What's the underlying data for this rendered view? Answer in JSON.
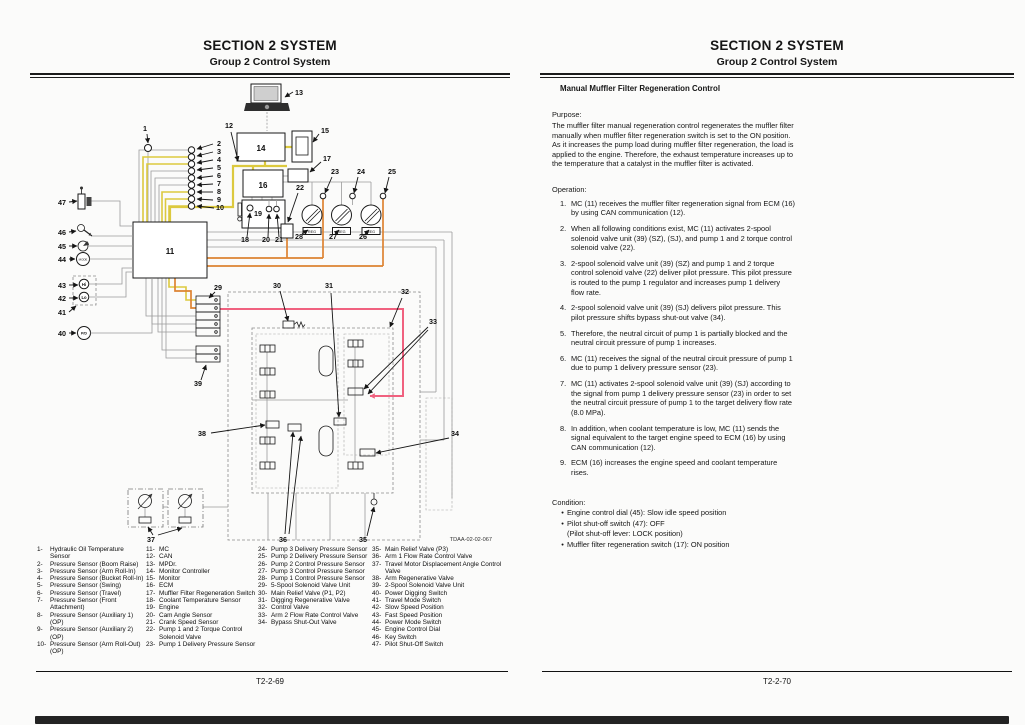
{
  "left_page": {
    "header": {
      "line1": "SECTION 2 SYSTEM",
      "line2": "Group 2 Control System"
    },
    "footer": {
      "page_number": "T2-2-69"
    },
    "diagram": {
      "figure_code": "TDAA-02-02-067",
      "component_text": {
        "reg": "REG",
        "hi": "Hi",
        "lo": "Lo",
        "power_dig": "P/D",
        "mode": "MODE"
      },
      "callouts": [
        "1",
        "2",
        "3",
        "4",
        "5",
        "6",
        "7",
        "8",
        "9",
        "10",
        "11",
        "12",
        "13",
        "14",
        "15",
        "16",
        "17",
        "18",
        "19",
        "20",
        "21",
        "22",
        "23",
        "24",
        "25",
        "26",
        "27",
        "28",
        "29",
        "30",
        "31",
        "32",
        "33",
        "34",
        "35",
        "36",
        "37",
        "38",
        "39",
        "40",
        "41",
        "42",
        "43",
        "44",
        "45",
        "46",
        "47"
      ]
    },
    "legend": {
      "col1": [
        {
          "n": "1-",
          "t": "Hydraulic Oil Temperature Sensor"
        },
        {
          "n": "2-",
          "t": "Pressure Sensor (Boom Raise)"
        },
        {
          "n": "3-",
          "t": "Pressure Sensor (Arm Roll-In)"
        },
        {
          "n": "4-",
          "t": "Pressure Sensor (Bucket Roll-In)"
        },
        {
          "n": "5-",
          "t": "Pressure Sensor (Swing)"
        },
        {
          "n": "6-",
          "t": "Pressure Sensor (Travel)"
        },
        {
          "n": "7-",
          "t": "Pressure Sensor (Front Attachment)"
        },
        {
          "n": "8-",
          "t": "Pressure Sensor (Auxiliary 1) (OP)"
        },
        {
          "n": "9-",
          "t": "Pressure Sensor (Auxiliary 2) (OP)"
        },
        {
          "n": "10-",
          "t": "Pressure Sensor (Arm Roll-Out) (OP)"
        }
      ],
      "col2": [
        {
          "n": "11-",
          "t": "MC"
        },
        {
          "n": "12-",
          "t": "CAN"
        },
        {
          "n": "13-",
          "t": "MPDr."
        },
        {
          "n": "14-",
          "t": "Monitor Controller"
        },
        {
          "n": "15-",
          "t": "Monitor"
        },
        {
          "n": "16-",
          "t": "ECM"
        },
        {
          "n": "17-",
          "t": "Muffler Filter Regeneration Switch"
        },
        {
          "n": "18-",
          "t": "Coolant Temperature Sensor"
        },
        {
          "n": "19-",
          "t": "Engine"
        },
        {
          "n": "20-",
          "t": "Cam Angle Sensor"
        },
        {
          "n": "21-",
          "t": "Crank Speed Sensor"
        },
        {
          "n": "22-",
          "t": "Pump 1 and 2 Torque Control Solenoid Valve"
        },
        {
          "n": "23-",
          "t": "Pump 1 Delivery Pressure Sensor"
        }
      ],
      "col3": [
        {
          "n": "24-",
          "t": "Pump 3 Delivery Pressure Sensor"
        },
        {
          "n": "25-",
          "t": "Pump 2 Delivery Pressure Sensor"
        },
        {
          "n": "26-",
          "t": "Pump 2 Control Pressure Sensor"
        },
        {
          "n": "27-",
          "t": "Pump 3 Control Pressure Sensor"
        },
        {
          "n": "28-",
          "t": "Pump 1 Control Pressure Sensor"
        },
        {
          "n": "29-",
          "t": "5-Spool Solenoid Valve Unit"
        },
        {
          "n": "30-",
          "t": "Main Relief Valve (P1, P2)"
        },
        {
          "n": "31-",
          "t": "Digging Regenerative Valve"
        },
        {
          "n": "32-",
          "t": "Control Valve"
        },
        {
          "n": "33-",
          "t": "Arm 2 Flow Rate Control Valve"
        },
        {
          "n": "34-",
          "t": "Bypass Shut-Out Valve"
        }
      ],
      "col4": [
        {
          "n": "35-",
          "t": "Main Relief Valve (P3)"
        },
        {
          "n": "36-",
          "t": "Arm 1 Flow Rate Control Valve"
        },
        {
          "n": "37-",
          "t": "Travel Motor Displacement Angle Control Valve"
        },
        {
          "n": "38-",
          "t": "Arm Regenerative Valve"
        },
        {
          "n": "39-",
          "t": "2-Spool Solenoid Valve Unit"
        },
        {
          "n": "40-",
          "t": "Power Digging Switch"
        },
        {
          "n": "41-",
          "t": "Travel Mode Switch"
        },
        {
          "n": "42-",
          "t": "Slow Speed Position"
        },
        {
          "n": "43-",
          "t": "Fast Speed Position"
        },
        {
          "n": "44-",
          "t": "Power Mode Switch"
        },
        {
          "n": "45-",
          "t": "Engine Control Dial"
        },
        {
          "n": "46-",
          "t": "Key Switch"
        },
        {
          "n": "47-",
          "t": "Pilot Shut-Off Switch"
        }
      ]
    }
  },
  "right_page": {
    "header": {
      "line1": "SECTION 2 SYSTEM",
      "line2": "Group 2 Control System"
    },
    "footer": {
      "page_number": "T2-2-70"
    },
    "title": "Manual Muffler Filter Regeneration Control",
    "purpose_label": "Purpose:",
    "purpose_paragraphs": [
      "The muffler filter manual regeneration control regenerates the muffler filter manually when muffler filter regeneration switch is set to the ON position.",
      "As it increases the pump load during muffler filter regeneration, the load is applied to the engine. Therefore, the exhaust temperature increases up to the temperature that a catalyst in the muffler filter is activated."
    ],
    "operation_label": "Operation:",
    "operation_steps": [
      {
        "n": "1.",
        "t": "MC (11) receives the muffler filter regeneration signal from ECM (16) by using CAN communication (12)."
      },
      {
        "n": "2.",
        "t": "When all following conditions exist, MC (11) activates 2-spool solenoid valve unit (39) (SZ), (SJ), and pump 1 and 2 torque control solenoid valve (22)."
      },
      {
        "n": "3.",
        "t": "2-spool solenoid valve unit (39) (SZ) and pump 1 and 2 torque control solenoid valve (22) deliver pilot pressure. This pilot pressure is routed to the pump 1 regulator and increases pump 1 delivery flow rate."
      },
      {
        "n": "4.",
        "t": "2-spool solenoid valve unit (39) (SJ) delivers pilot pressure. This pilot pressure shifts bypass shut-out valve (34)."
      },
      {
        "n": "5.",
        "t": "Therefore, the neutral circuit of pump 1 is partially blocked and the neutral circuit pressure of pump 1 increases."
      },
      {
        "n": "6.",
        "t": "MC (11) receives the signal of the neutral circuit pressure of pump 1 due to pump 1 delivery pressure sensor (23)."
      },
      {
        "n": "7.",
        "t": "MC (11) activates 2-spool solenoid valve unit (39) (SJ) according to the signal from pump 1 delivery pressure sensor (23) in order to set the neutral circuit pressure of pump 1 to the target delivery flow rate (8.0 MPa)."
      },
      {
        "n": "8.",
        "t": "In addition, when coolant temperature is low, MC (11) sends the signal equivalent to the target engine speed to ECM (16) by using CAN communication (12)."
      },
      {
        "n": "9.",
        "t": "ECM (16) increases the engine speed and coolant temperature rises."
      }
    ],
    "condition_label": "Condition:",
    "bullet_char": "•",
    "conditions": [
      "Engine control dial (45): Slow idle speed position",
      "Pilot shut-off switch (47): OFF\n(Pilot shut-off lever: LOCK position)",
      "Muffler filter regeneration switch (17): ON position"
    ]
  },
  "colors": {
    "can_yellow": "#dcc93e",
    "pilot_orange": "#dd8331",
    "highlight_pink": "#f0617f"
  }
}
